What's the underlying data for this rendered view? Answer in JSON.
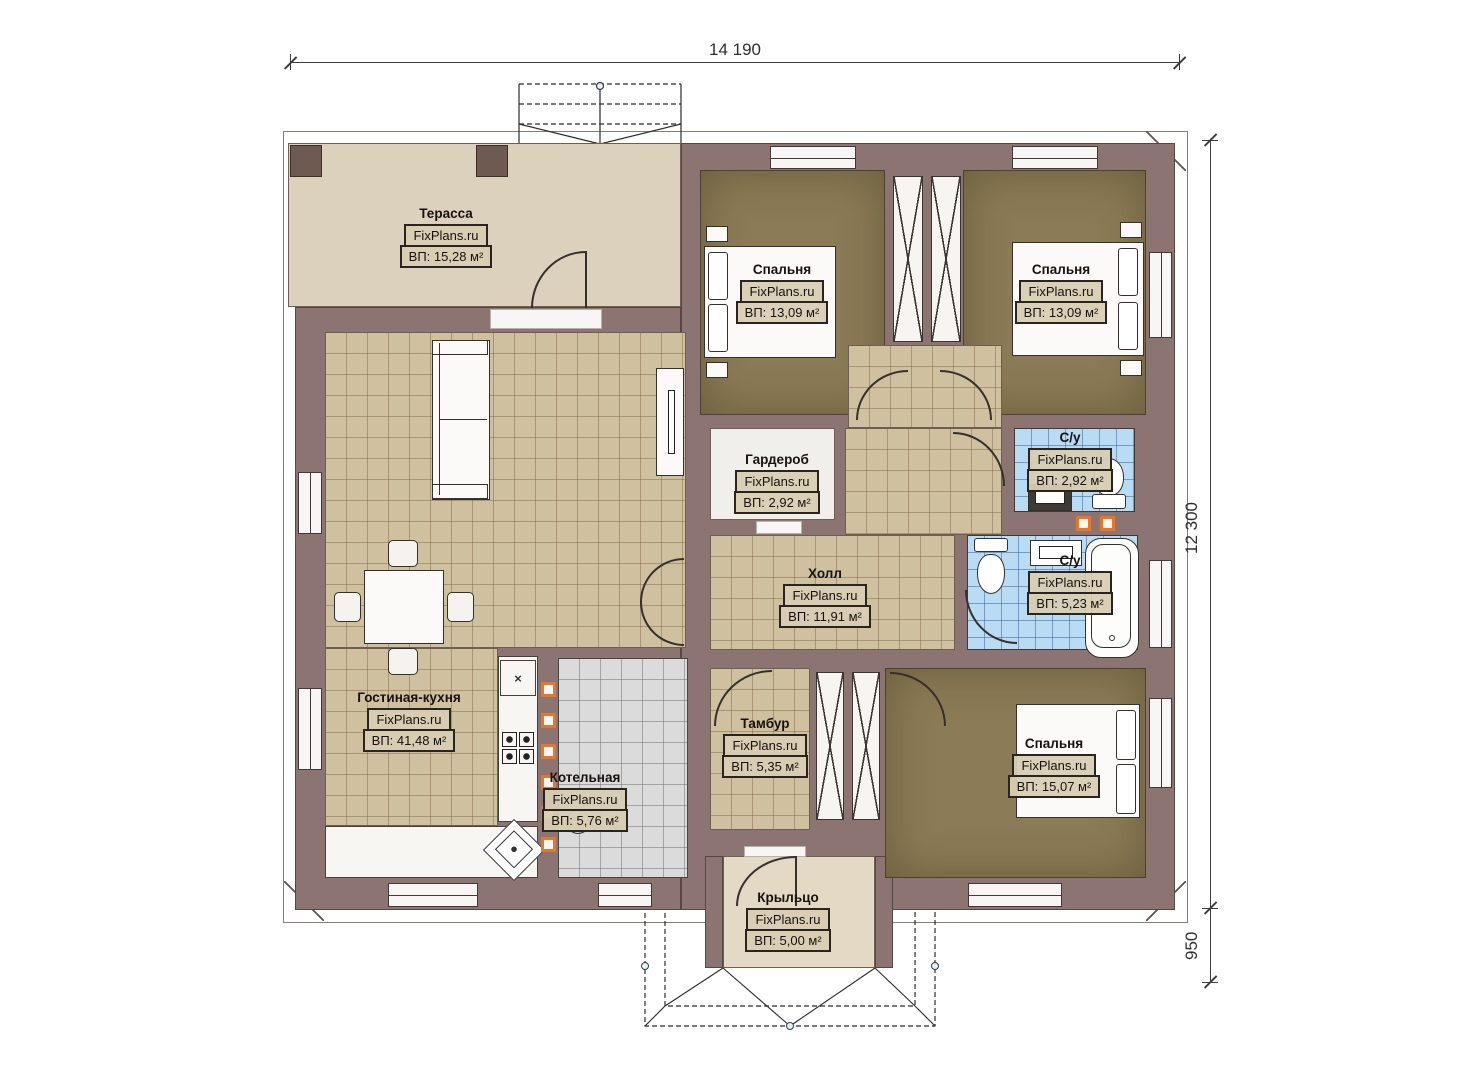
{
  "brand": "FixPlans.ru",
  "dimensions": {
    "width_top": "14 190",
    "height_right": "12 300",
    "porch_height": "950"
  },
  "rooms": [
    {
      "name": "Терасса",
      "brand": "FixPlans.ru",
      "area": "ВП: 15,28 м²"
    },
    {
      "name": "Спальня",
      "brand": "FixPlans.ru",
      "area": "ВП: 13,09 м²"
    },
    {
      "name": "Спальня",
      "brand": "FixPlans.ru",
      "area": "ВП: 13,09 м²"
    },
    {
      "name": "Гардероб",
      "brand": "FixPlans.ru",
      "area": "ВП: 2,92 м²"
    },
    {
      "name": "С/у",
      "brand": "FixPlans.ru",
      "area": "ВП: 2,92 м²"
    },
    {
      "name": "Холл",
      "brand": "FixPlans.ru",
      "area": "ВП: 11,91 м²"
    },
    {
      "name": "С/у",
      "brand": "FixPlans.ru",
      "area": "ВП: 5,23 м²"
    },
    {
      "name": "Гостиная-кухня",
      "brand": "FixPlans.ru",
      "area": "ВП: 41,48 м²"
    },
    {
      "name": "Тамбур",
      "brand": "FixPlans.ru",
      "area": "ВП: 5,35 м²"
    },
    {
      "name": "Котельная",
      "brand": "FixPlans.ru",
      "area": "ВП: 5,76 м²"
    },
    {
      "name": "Спальня",
      "brand": "FixPlans.ru",
      "area": "ВП: 15,07 м²"
    },
    {
      "name": "Крыльцо",
      "brand": "FixPlans.ru",
      "area": "ВП: 5,00 м²"
    }
  ],
  "symbols": {
    "kitchen_vent": "×"
  },
  "colors": {
    "wall": "#8b7471",
    "terrace_floor": "#dcd1bc",
    "tile_tan": "#cfc0a0",
    "bedroom_floor": "#8b7b56",
    "tile_blue": "#badbf4",
    "tile_gray": "#dbdbdb",
    "accent_orange": "#e8762a"
  }
}
